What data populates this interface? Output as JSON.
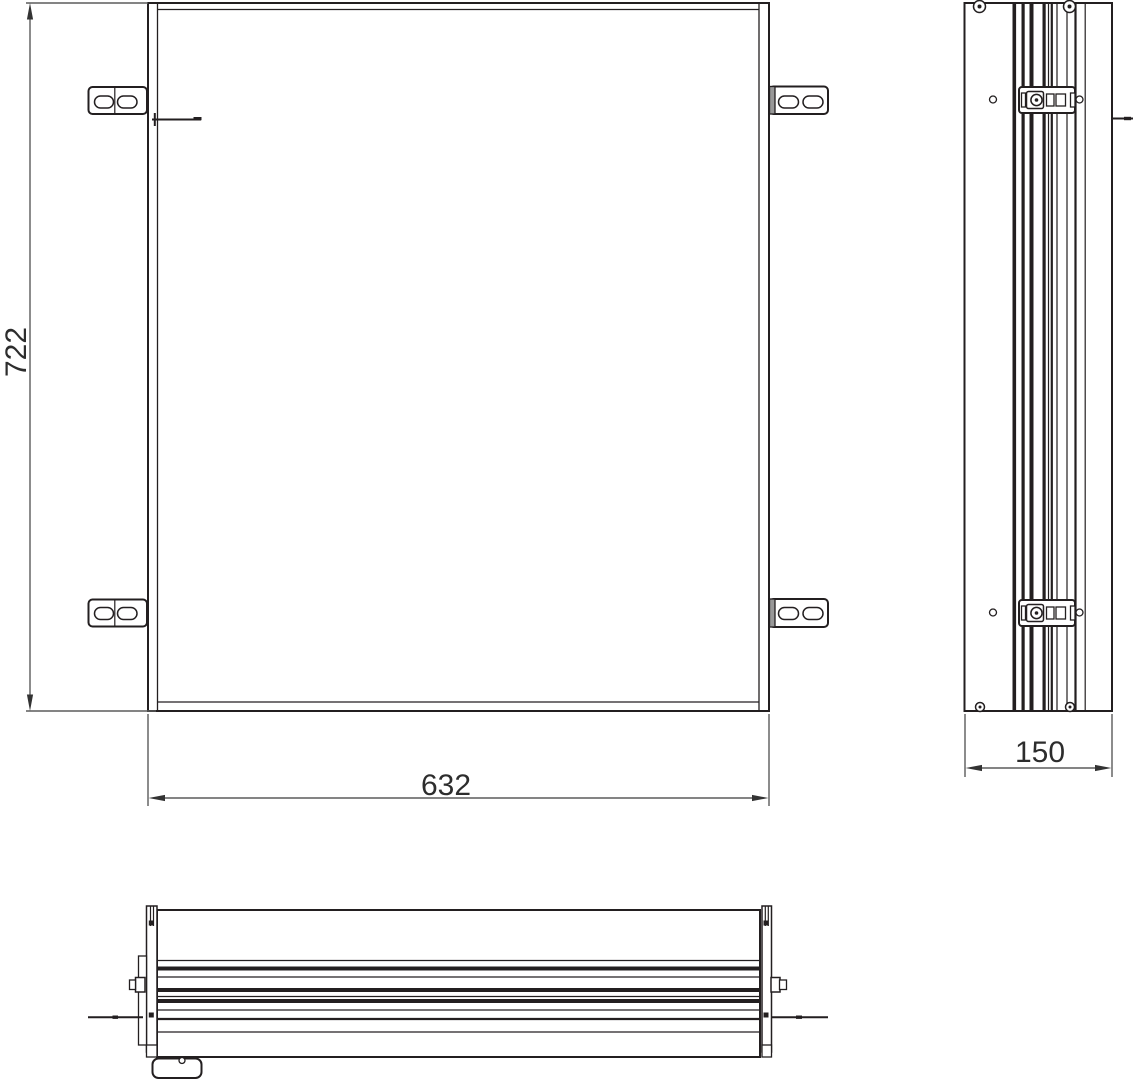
{
  "dimensions": {
    "height_mm": "722",
    "width_mm": "632",
    "depth_mm": "150"
  },
  "colors": {
    "line": "#231f20",
    "dimension_line": "#5b5b5b",
    "arrowhead": "#333333",
    "bracket_shading": "#989898",
    "background": "#ffffff"
  }
}
